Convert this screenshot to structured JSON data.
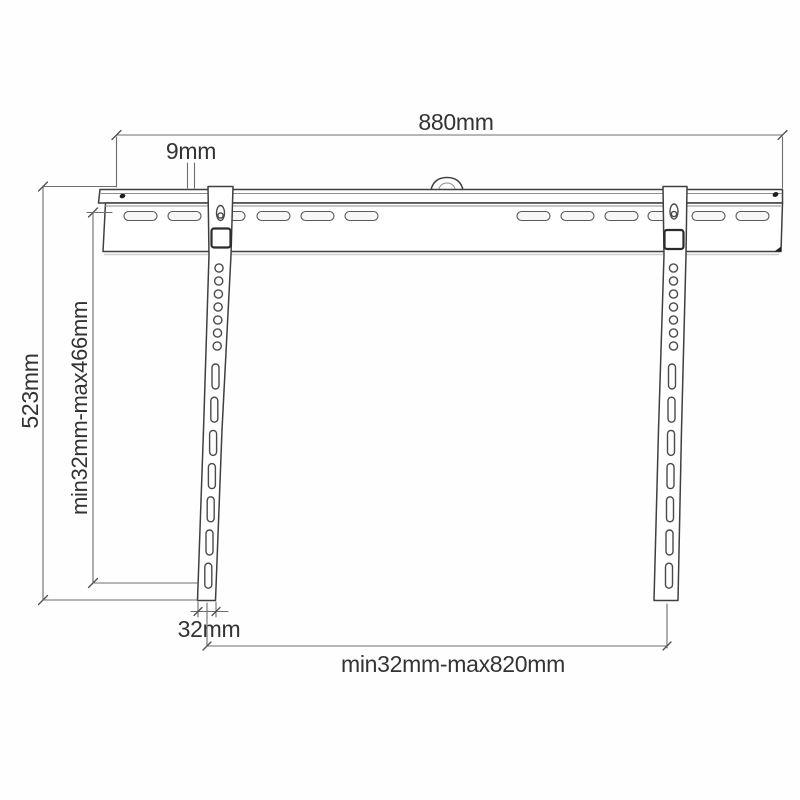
{
  "diagram": {
    "subject": "tv-wall-mount-bracket-dimension-drawing",
    "dimensions": {
      "total_width": "880mm",
      "hook_depth": "9mm",
      "total_height": "523mm",
      "vertical_hole_range": "min32mm-max466mm",
      "arm_width": "32mm",
      "horizontal_hole_range": "min32mm-max820mm"
    }
  }
}
